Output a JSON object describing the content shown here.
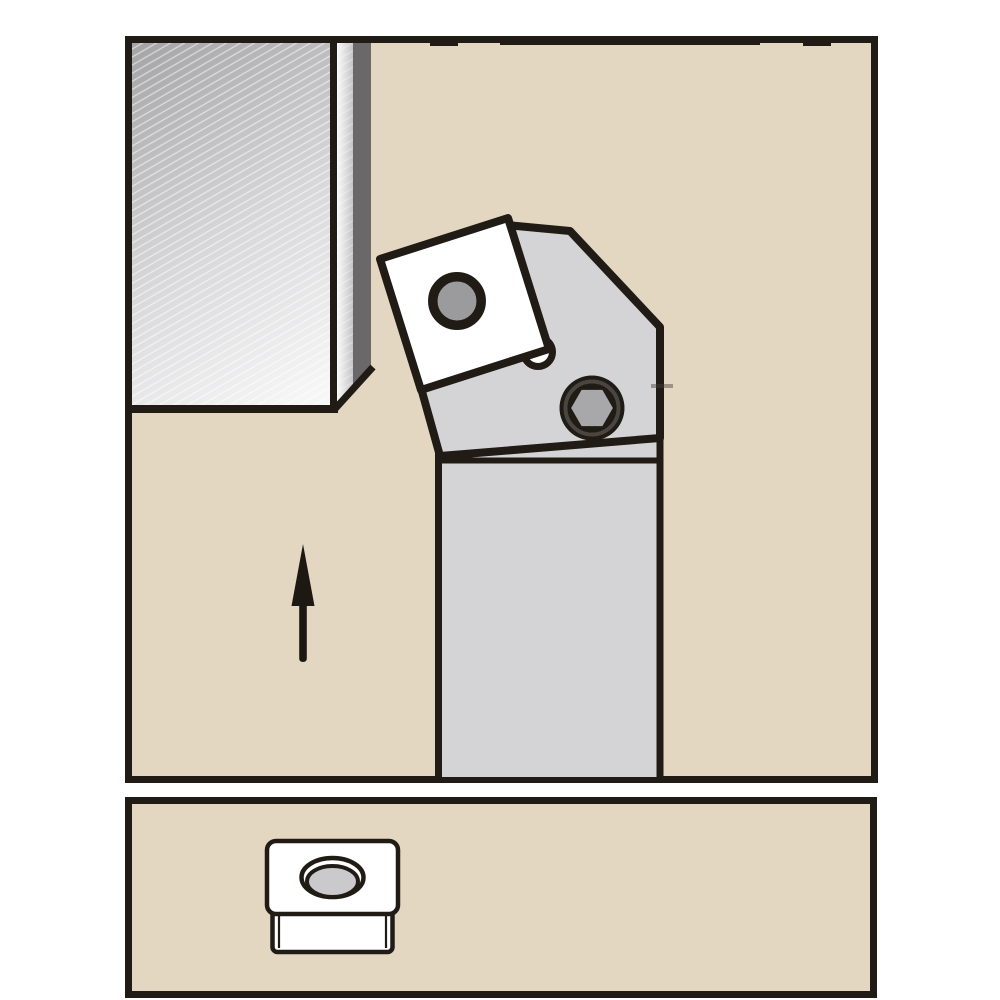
{
  "scene": {
    "type": "technical-illustration",
    "description": "Lathe turning tool holder with square indexable insert cutting a workpiece, upward feed-direction arrow, and a legend panel below showing a square insert pictogram with countersunk hole",
    "text_content": [],
    "icons": {
      "feed_direction_arrow": "up-arrow",
      "clamp_screw": "hex-socket-screw",
      "insert_pictogram": "square-insert-with-countersunk-hole"
    },
    "panels": {
      "main": {
        "content": "workpiece, tool holder head, indexable insert, clamp hex screw, feed arrow"
      },
      "legend": {
        "content": "insert shape pictogram"
      }
    }
  },
  "colors": {
    "panel_beige": "#E3D7C2",
    "outline_black": "#201B15",
    "holder_gray": "#D4D4D6",
    "insert_white": "#FFFFFF",
    "insert_hole_gray": "#9B9B9D",
    "hex_socket_gray": "#A8A8AA",
    "screw_shade_gray": "#4A4540",
    "workpiece_side_dark": "#6B686A",
    "workpiece_grad_dark": "#A4A4A6",
    "workpiece_grad_mid": "#D8D8DA",
    "workpiece_grad_light": "#F6F6F7",
    "machined_strip_light": "#FBFBFB",
    "machined_strip_shadow": "#C4C4C6",
    "icon_countersink_gray": "#CACACC",
    "hatch_white": "#FFFFFF",
    "arrow_black": "#1E1812",
    "artifact_tick_gray": "rgba(70,64,58,0.45)"
  }
}
